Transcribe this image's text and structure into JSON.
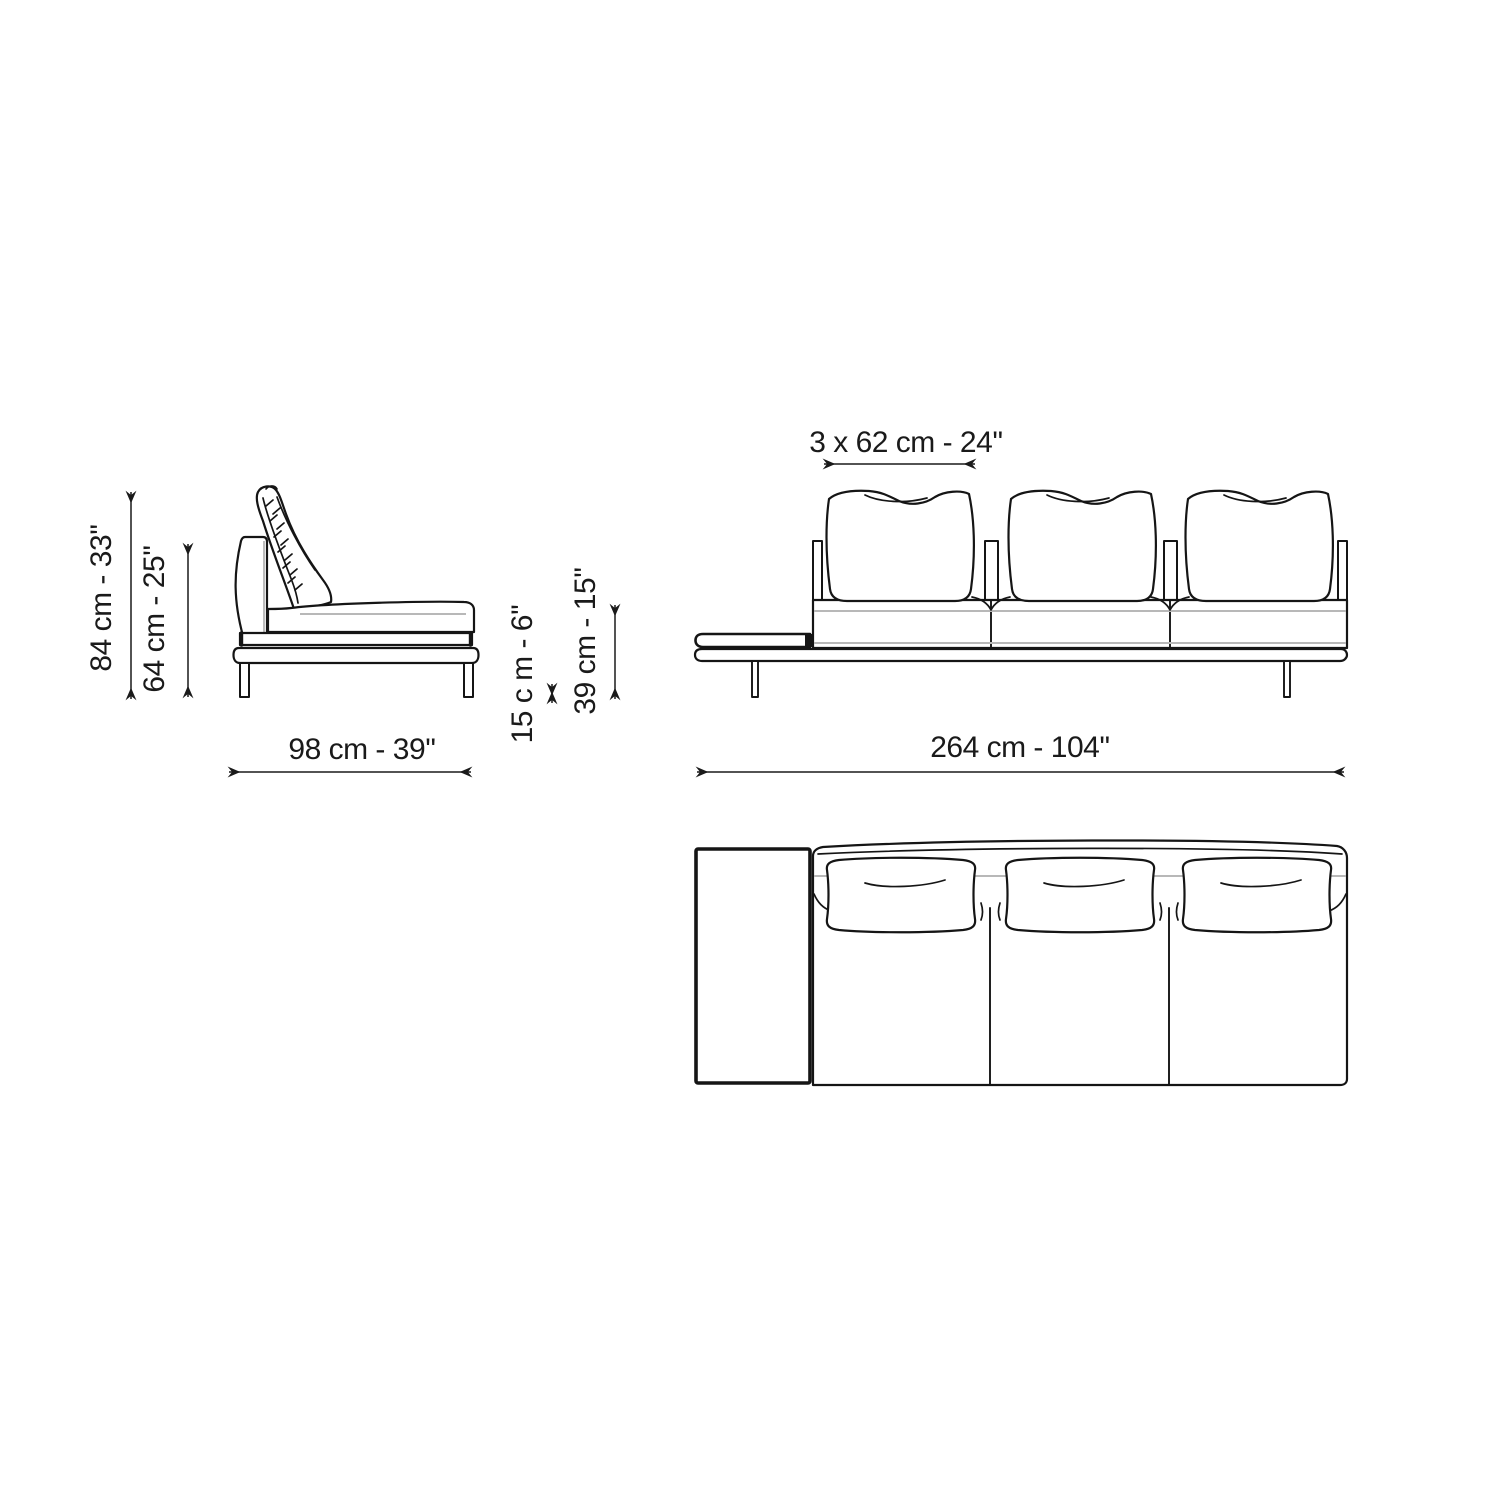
{
  "colors": {
    "line": "#151515",
    "seam_gray": "#b8b8b8",
    "background": "#ffffff",
    "dimension_text": "#1a1a1a"
  },
  "dims": {
    "total_height": "84 cm - 33''",
    "back_height": "64 cm - 25''",
    "depth": "98 cm - 39''",
    "shelf_height": "15 c m - 6''",
    "seat_height": "39 cm - 15''",
    "cushion_width": "3 x 62 cm - 24''",
    "total_width": "264 cm - 104''"
  }
}
